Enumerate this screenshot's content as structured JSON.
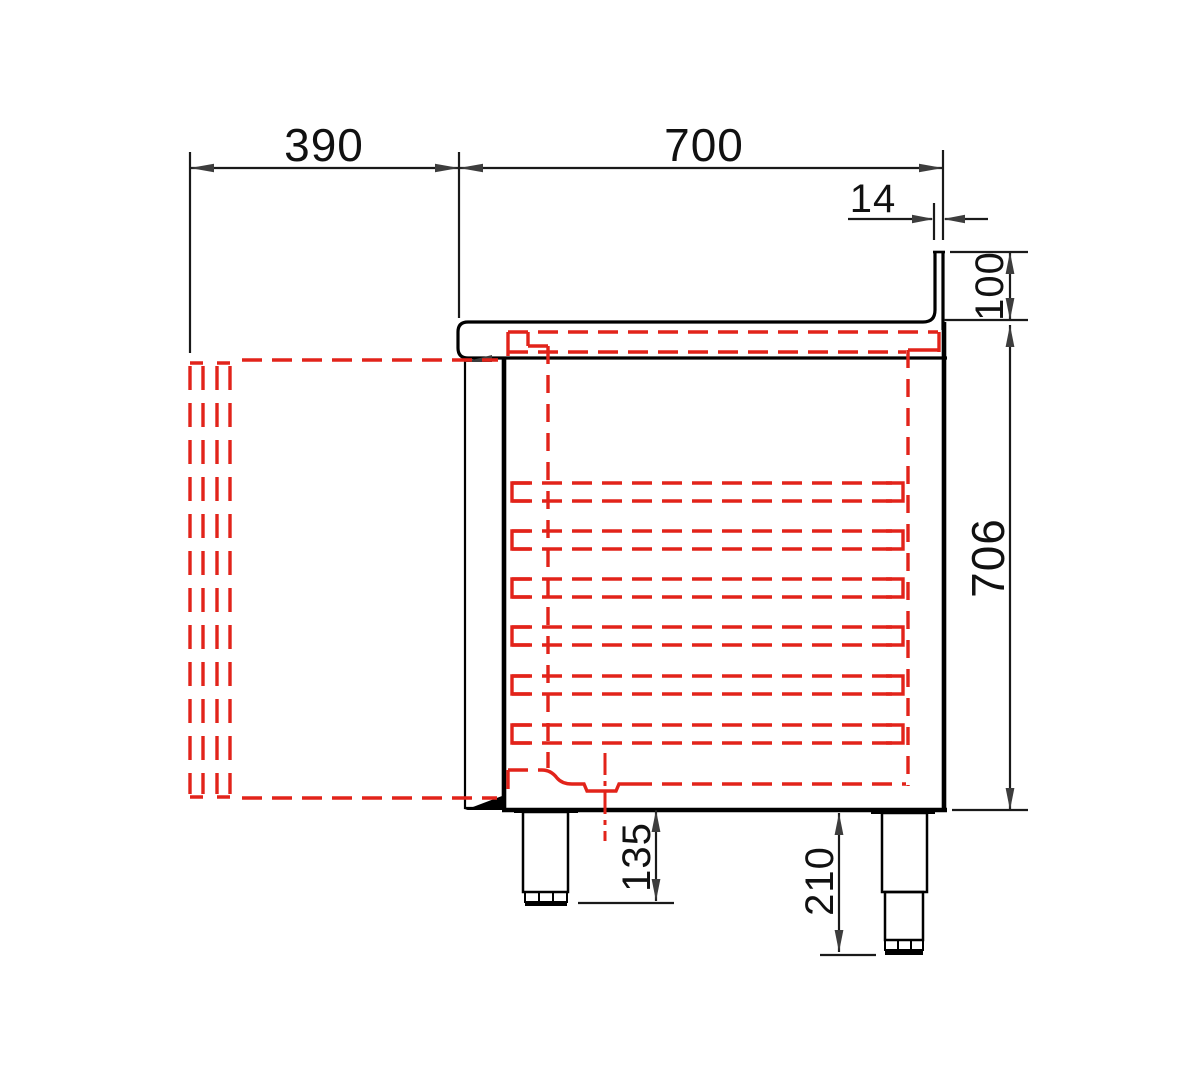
{
  "drawing": {
    "type": "side-section technical drawing of a refrigerated counter with open-door swing shown dashed",
    "dimensions": {
      "door_open_depth": "390",
      "body_depth": "700",
      "backsplash_thickness": "14",
      "backsplash_height": "100",
      "body_height": "706",
      "leg_height_min": "135",
      "leg_height_max": "210"
    },
    "shelf_count": 6,
    "colors": {
      "outline": "#000000",
      "hidden_detail_red": "#e2231a",
      "dimension_text": "#1a1a1a"
    }
  }
}
